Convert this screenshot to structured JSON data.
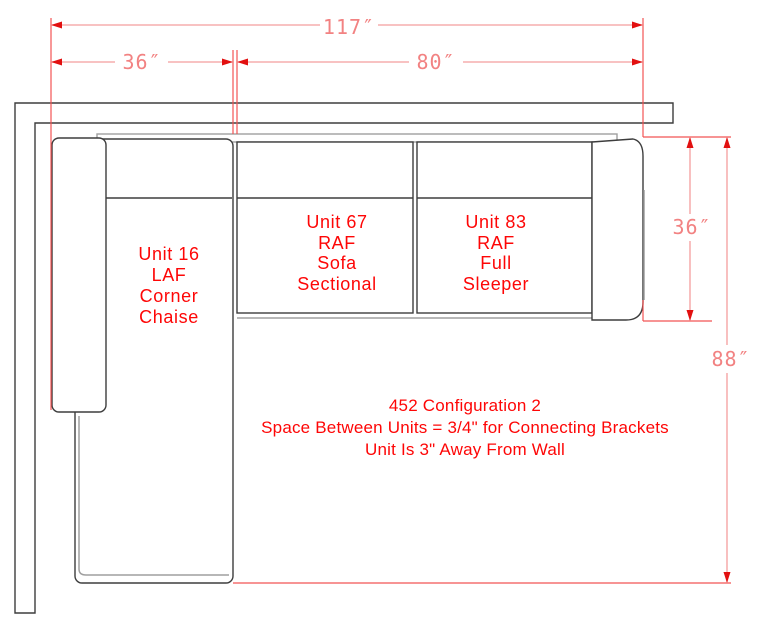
{
  "drawing": {
    "dims": {
      "total_width": "117″",
      "chaise_width": "36″",
      "sofa_width": "80″",
      "sofa_depth": "36″",
      "total_depth": "88″"
    },
    "units": [
      {
        "id": "unit-16",
        "lines": [
          "Unit 16",
          "LAF",
          "Corner",
          "Chaise"
        ]
      },
      {
        "id": "unit-67",
        "lines": [
          "Unit 67",
          "RAF",
          "Sofa",
          "Sectional"
        ]
      },
      {
        "id": "unit-83",
        "lines": [
          "Unit 83",
          "RAF",
          "Full",
          "Sleeper"
        ]
      }
    ],
    "notes": [
      "452 Configuration 2",
      "Space Between Units = 3/4\" for Connecting Brackets",
      "Unit Is 3\" Away From Wall"
    ],
    "colors": {
      "label_red": "#fe0606",
      "dimension_pink": "#f49d9d",
      "extension_red": "#f25353",
      "arrow_red": "#e21010",
      "outline_dark": "#3d3d3d",
      "outline_gray": "#9f9f9f"
    }
  }
}
